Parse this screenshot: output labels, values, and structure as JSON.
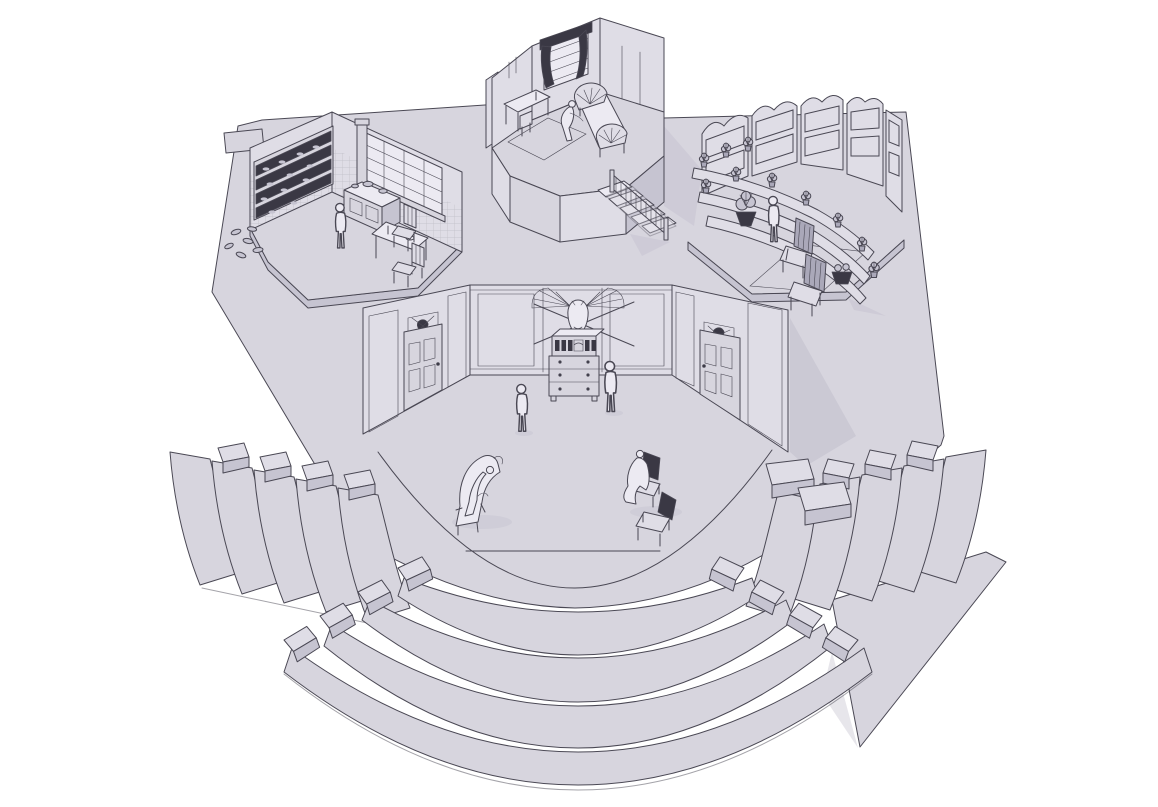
{
  "meta": {
    "title": "Monochrome 3D model render of a thrust-stage theater set with terraced audience seating",
    "style": "grey-lavender clay render on white background, dark ink outlines, no text"
  },
  "colors": {
    "bg": "#ffffff",
    "surface": "#d7d5de",
    "surfaceLight": "#dfdde6",
    "surfaceBright": "#eceaf2",
    "shadow": "#c6c4d1",
    "shadowDark": "#aaa8b9",
    "shadowSoft": "#b9b7c6",
    "outline": "#4a4854",
    "ink": "#3a3844"
  },
  "scene": {
    "stage": {
      "name": "stage-floor",
      "shape": "irregular polygon with curved downstage apron and notched edges",
      "markings": [
        "curved apron boundary arc",
        "short straight spike-mark line downstage center"
      ]
    },
    "sets": [
      {
        "id": "kitchen-set",
        "label": "kitchen scene, upstage left, hexagonal platform",
        "props": [
          "tiled corner walls",
          "wall shelves crowded with dark dishes",
          "plates tumbling off shelf end",
          "large grid window",
          "wood stove with pots and chimney pipe",
          "small dining table with plates",
          "two chairs"
        ],
        "figures": 1
      },
      {
        "id": "bedroom-set",
        "label": "bedroom scene, upstage center on raised platform",
        "props": [
          "curtained window with valance",
          "writing desk and chair",
          "area rug",
          "bed with fan-spindle headboard and footboard",
          "balustraded staircase down to stage"
        ],
        "figures": 1
      },
      {
        "id": "library-set",
        "label": "library scene, upstage right, hexagonal platform",
        "props": [
          "curved arched bookcases full of books",
          "stepped plant ledges",
          "nine potted plants",
          "floor urn with large plant",
          "area rug",
          "two high-back armchairs",
          "dark planter pot"
        ],
        "figures": 1
      },
      {
        "id": "parlor-set",
        "label": "main parlor, center stage, three paneled walls",
        "props": [
          "left paneled door with trophy mount above",
          "right paneled door with trophy mount above",
          "moose head mounted on crossed poles",
          "bureau with pigeonhole hutch and three drawers",
          "chaise longue",
          "dark-backed chair pair"
        ],
        "figures": 4
      }
    ],
    "seating": {
      "left_bank": {
        "label": "house-left terraced seating",
        "tiers": 5,
        "entry_blocks": 4
      },
      "right_bank": {
        "label": "house-right terraced seating",
        "tiers": 5,
        "entry_blocks": 4,
        "extra": "long side skirt panel tapering downstage"
      },
      "front_bank": {
        "label": "downstage curved seating",
        "rows": 4,
        "end_blocks_per_row": 2
      },
      "side_steps": {
        "label": "step blocks between apron and house-right bank",
        "count": 2
      }
    },
    "figures_total": 7
  }
}
